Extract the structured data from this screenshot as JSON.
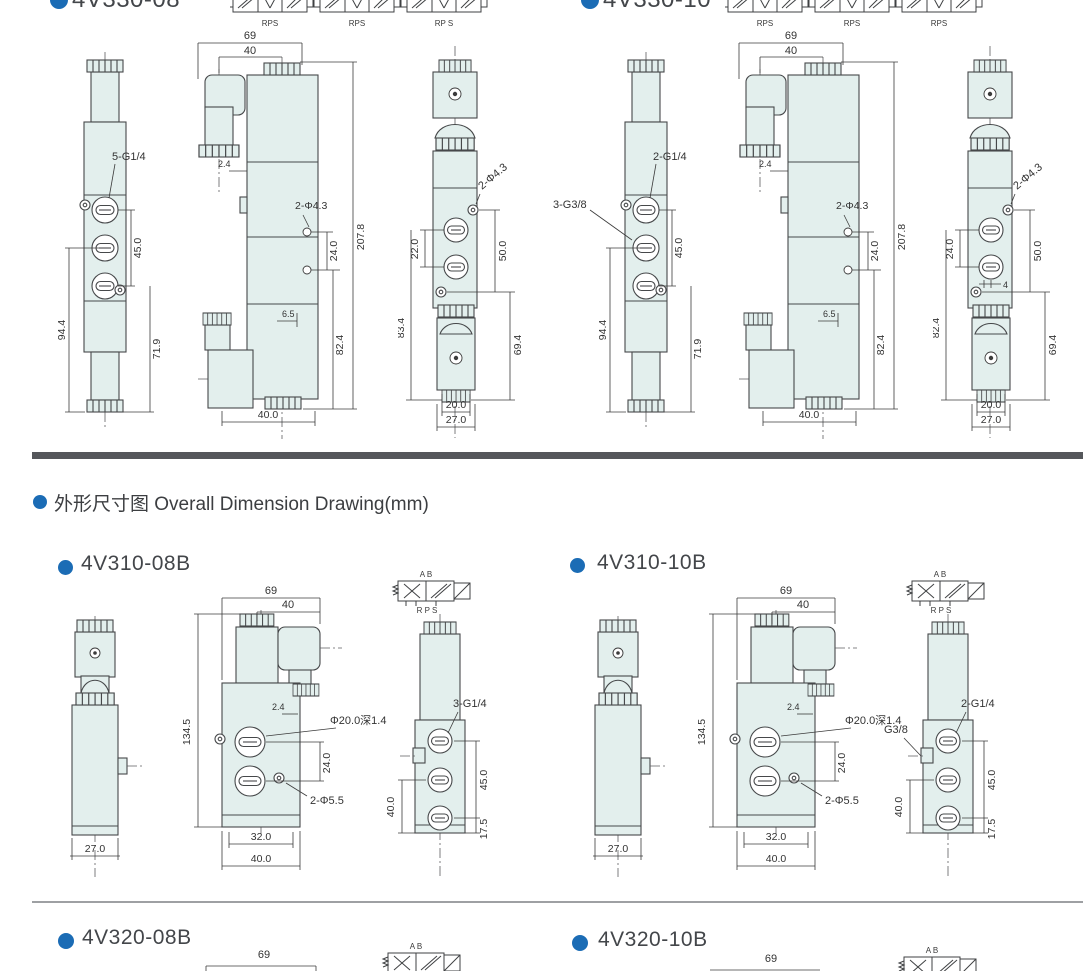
{
  "colors": {
    "accent_blue": "#1b6cb5",
    "divider_dark": "#55575b",
    "drawing_fill": "#e3efed",
    "line": "#46484a"
  },
  "heading": {
    "text": "外形尺寸图 Overall Dimension Drawing(mm)"
  },
  "s330_08": {
    "title": "4V330-08",
    "symbols": {
      "s1": "RPS",
      "s2": "RPS",
      "s3": "RP S"
    },
    "side": {
      "port_label": "5-G1/4",
      "d45": "45.0",
      "d94": "94.4",
      "d71": "71.9"
    },
    "front": {
      "d69": "69",
      "d40": "40",
      "d2_4": "2.4",
      "holes": "2-Φ4.3",
      "d24": "24.0",
      "d207": "207.8",
      "d6_5": "6.5",
      "d82": "82.4",
      "d40b": "40.0"
    },
    "end": {
      "holes": "2-Φ4.3",
      "dports": "22.0",
      "d50": "50.0",
      "douter_l": "83.4",
      "douter_r": "69.4",
      "d20": "20.0",
      "d27": "27.0"
    }
  },
  "s330_10": {
    "title": "4V330-10",
    "symbols": {
      "s1": "RPS",
      "s2": "RPS",
      "s3": "RPS"
    },
    "side": {
      "port_label": "2-G1/4",
      "port_label2": "3-G3/8",
      "d45": "45.0",
      "d94": "94.4",
      "d71": "71.9"
    },
    "front": {
      "d69": "69",
      "d40": "40",
      "d2_4": "2.4",
      "holes": "2-Φ4.3",
      "d24": "24.0",
      "d207": "207.8",
      "d6_5": "6.5",
      "d82": "82.4",
      "d40b": "40.0"
    },
    "end": {
      "holes": "2-Φ4.3",
      "dports": "24.0",
      "d50": "50.0",
      "d4": "4",
      "douter_l": "82.4",
      "douter_r": "69.4",
      "d20": "20.0",
      "d27": "27.0"
    }
  },
  "s310_08": {
    "title": "4V310-08B",
    "symbol": {
      "ab": "A B",
      "rps": "R P S"
    },
    "side": {
      "d27": "27.0"
    },
    "front": {
      "d69": "69",
      "d40": "40",
      "d134": "134.5",
      "d2_4": "2.4",
      "phi": "Φ20.0深1.4",
      "d24": "24.0",
      "holes": "2-Φ5.5",
      "d32": "32.0",
      "d40b": "40.0"
    },
    "end": {
      "label_top": "3-G1/4",
      "d45": "45.0",
      "d40": "40.0",
      "d17": "17.5"
    }
  },
  "s310_10": {
    "title": "4V310-10B",
    "symbol": {
      "ab": "A B",
      "rps": "R P S"
    },
    "side": {
      "d27": "27.0"
    },
    "front": {
      "d69": "69",
      "d40": "40",
      "d134": "134.5",
      "d2_4": "2.4",
      "phi": "Φ20.0深1.4",
      "d24": "24.0",
      "holes": "2-Φ5.5",
      "d32": "32.0",
      "d40b": "40.0"
    },
    "end": {
      "label_top": "2-G1/4",
      "label_left": "G3/8",
      "d45": "45.0",
      "d40": "40.0",
      "d17": "17.5"
    }
  },
  "s320_08": {
    "title": "4V320-08B",
    "d69": "69",
    "symbol": {
      "ab": "A B"
    }
  },
  "s320_10": {
    "title": "4V320-10B",
    "d69": "69",
    "symbol": {
      "ab": "A B"
    }
  }
}
